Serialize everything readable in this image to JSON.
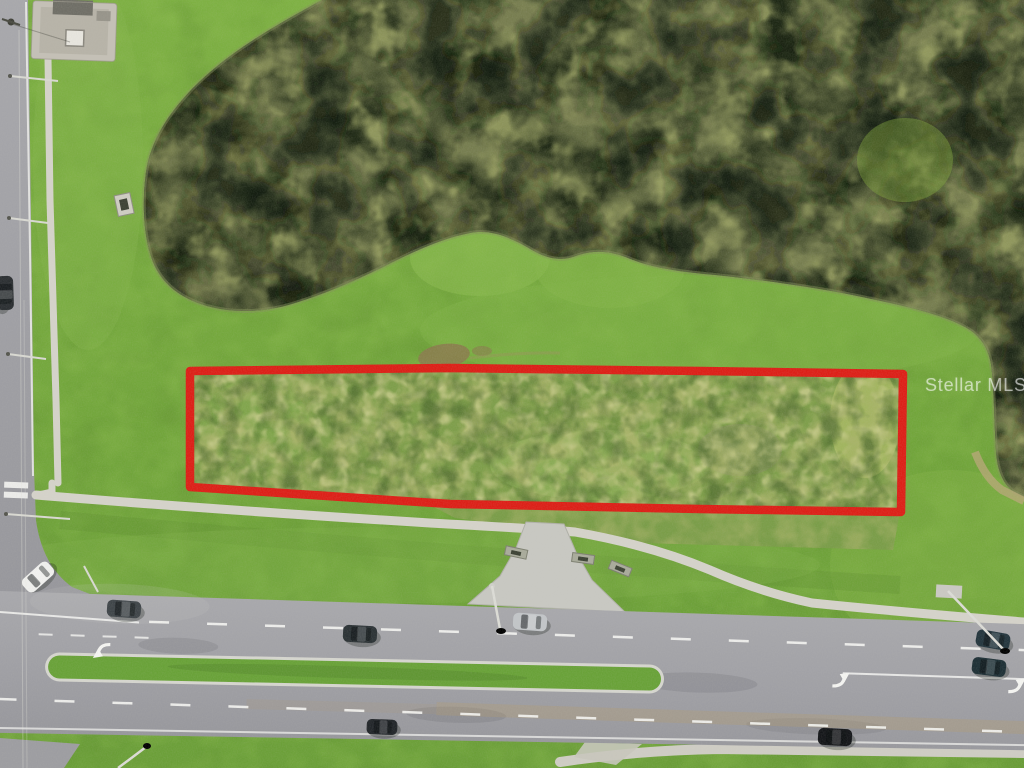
{
  "photo": {
    "kind": "aerial drone photograph",
    "scene": "vacant land parcel outlined in red between a wetland pond and a divided highway"
  },
  "watermark": {
    "text": "Stellar MLS"
  },
  "parcel": {
    "outline_points": "190,371 450,368 700,371 903,374 901,512 700,509 450,504 190,487",
    "outline_color": "#dd1f17",
    "outline_width": "8.5"
  },
  "colors": {
    "grass": "#74a73c",
    "wetland_water": "#1d2714",
    "tree_canopy": "#7b8252",
    "asphalt": "#a2a2a6",
    "concrete_sidewalk": "#d5d3ca",
    "median_grass": "#69a238",
    "marking_white": "#f5f5f2",
    "dirt_patch": "#8b7a4e"
  },
  "objects": {
    "vehicles_visible": 9,
    "turn_arrow_markings": 3,
    "crosswalk_bars": 2,
    "streetlights_visible": 6
  }
}
